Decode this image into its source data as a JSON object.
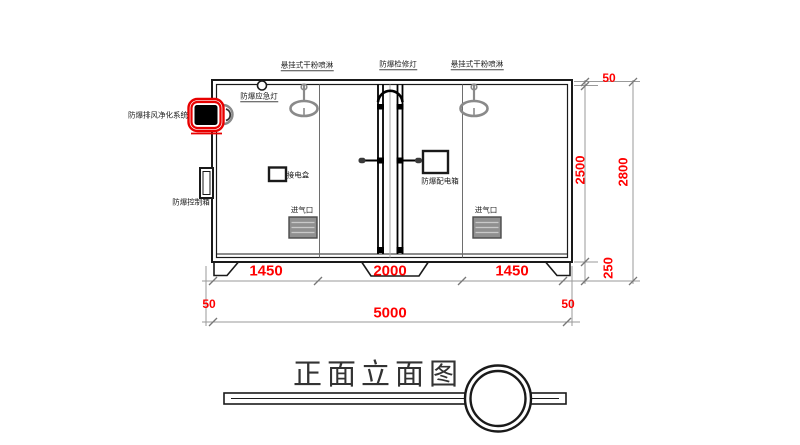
{
  "drawing": {
    "equipment_labels": {
      "sprinkler_left": "悬挂式干粉喷淋",
      "maintenance_light": "防爆检修灯",
      "sprinkler_right": "悬挂式干粉喷淋",
      "emergency_light": "防爆应急灯",
      "exhaust_purification_system": "防爆排风净化系统",
      "control_box": "防爆控制箱",
      "junction_box": "接电盒",
      "distribution_box": "防爆配电箱",
      "air_inlet_left": "进气口",
      "air_inlet_right": "进气口"
    },
    "dimensions": {
      "bottom_segments": [
        "1450",
        "2000",
        "1450"
      ],
      "offset_left": "50",
      "total_width": "5000",
      "offset_right": "50",
      "roof_thickness": "50",
      "interior_height": "2500",
      "base_height": "250",
      "total_height": "2800"
    },
    "title": "正面立面图",
    "colors": {
      "dimension_text": "#FF0000",
      "highlight_red": "#E80000",
      "line_black": "#1A1A1A",
      "equipment_gray": "#8A8A8A",
      "dimension_line_gray": "#9A9A9A"
    }
  }
}
